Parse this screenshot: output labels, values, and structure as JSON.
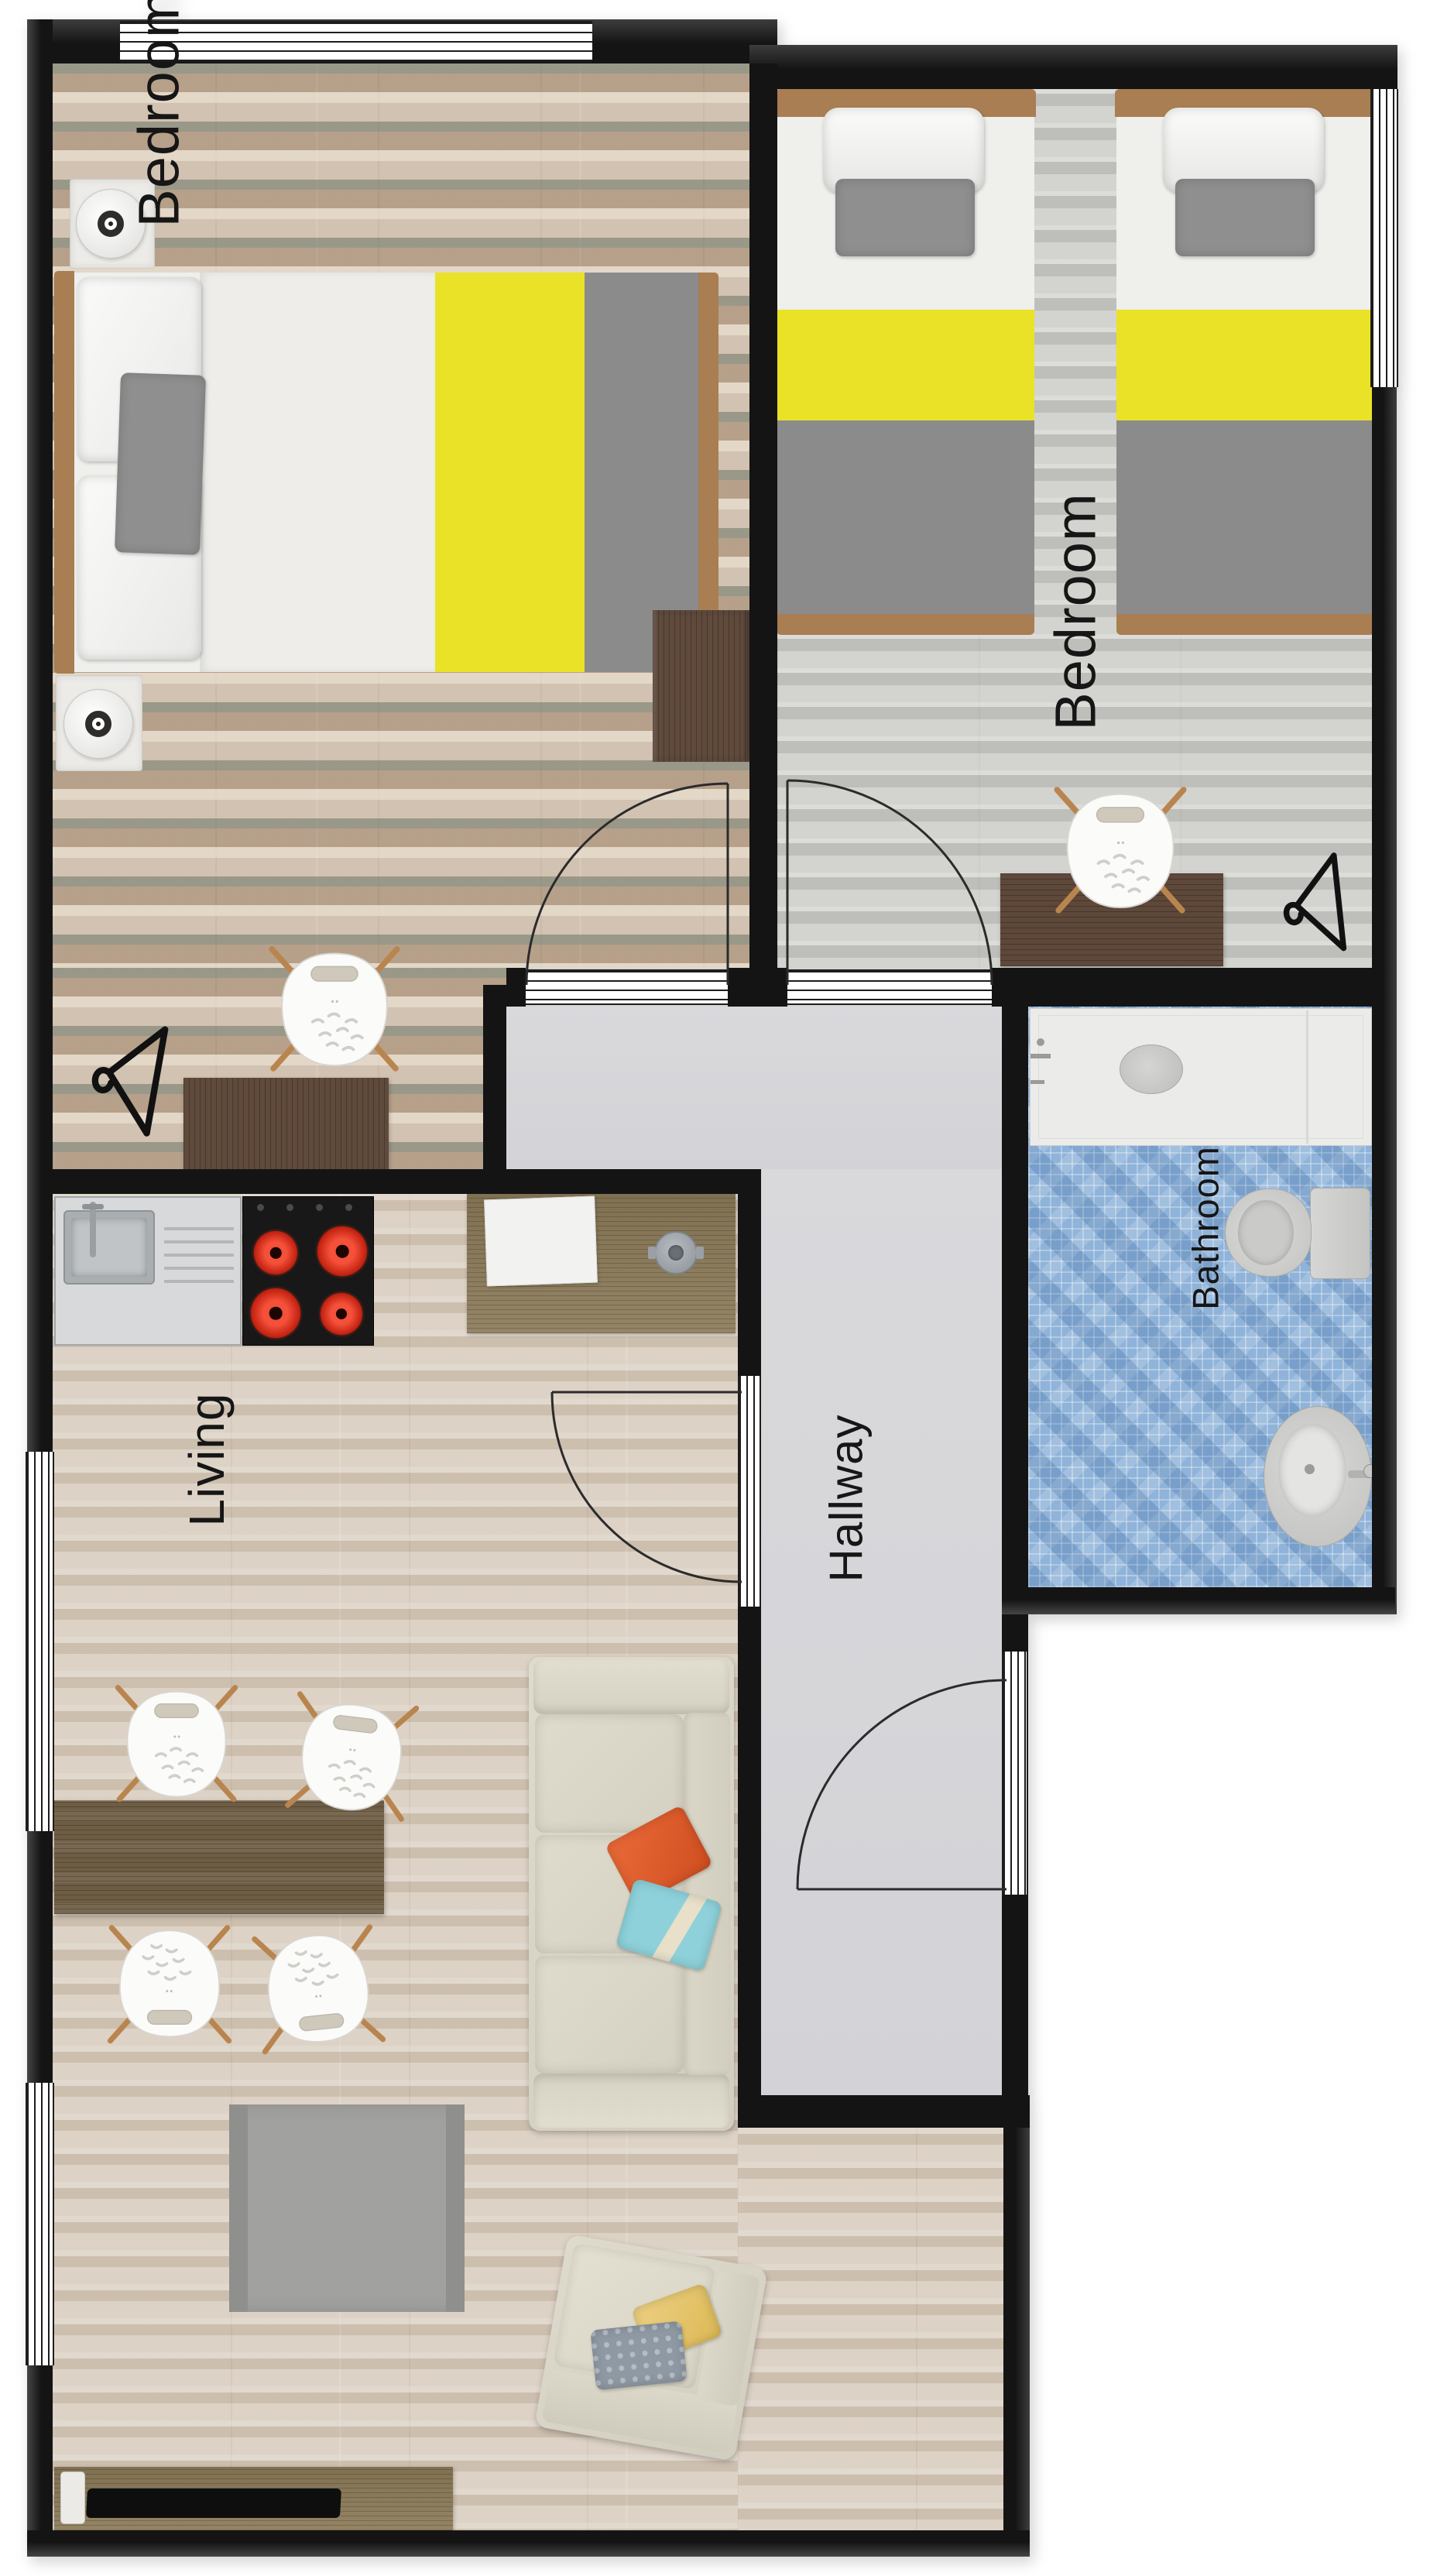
{
  "title": "Apartment floor plan",
  "rooms": {
    "bedroom_left": {
      "label": "Bedroom",
      "items": [
        "double-bed",
        "nightstand-lamp",
        "nightstand-lamp",
        "dresser",
        "desk",
        "desk-chair",
        "clothes-hanger"
      ]
    },
    "bedroom_right": {
      "label": "Bedroom",
      "items": [
        "twin-bed",
        "twin-bed",
        "desk",
        "desk-chair",
        "clothes-hanger"
      ]
    },
    "bathroom": {
      "label": "Bathroom",
      "items": [
        "shower",
        "toilet",
        "washbasin"
      ]
    },
    "hallway": {
      "label": "Hallway",
      "items": [
        "entry-door"
      ]
    },
    "living": {
      "label": "Living",
      "items": [
        "kitchen-sink",
        "stove",
        "kitchen-island",
        "dining-table",
        "dining-chair",
        "dining-chair",
        "dining-chair",
        "dining-chair",
        "sofa",
        "armchair",
        "rug",
        "tv-cabinet",
        "tv-soundbar"
      ]
    }
  },
  "colors": {
    "wall": "#141414",
    "accent_yellow": "#e9e227",
    "blanket_gray": "#8b8b8b",
    "headboard_wood": "#a87e52",
    "pillow_orange": "#e05a2a",
    "pillow_teal": "#86ccd6",
    "pillow_yellow": "#e8c96b",
    "pillow_gray_blue": "#8e99a4",
    "burner_red": "#d22b18",
    "mosaic_blue": "#8fb3d9",
    "hallway_floor": "#d9d9dc",
    "chair_wood_leg": "#b9854e",
    "label_text": "#161616"
  }
}
